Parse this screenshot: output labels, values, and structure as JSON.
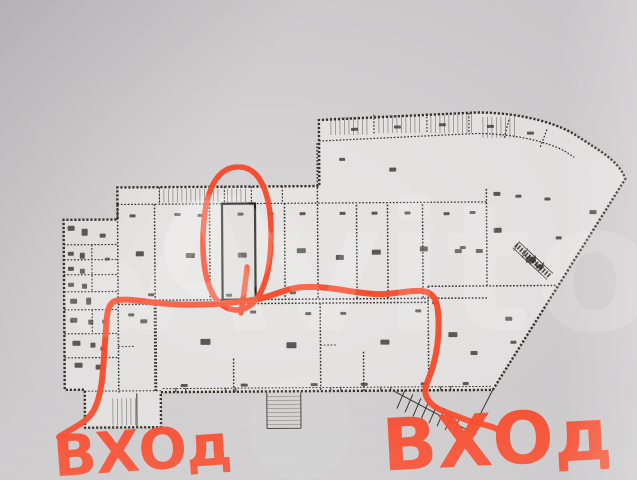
{
  "watermark": {
    "text": "Avito"
  },
  "annotations": {
    "entrance_left_label": "ВХОд",
    "entrance_right_label": "ВХОд",
    "marker_color": "#f8492a"
  },
  "plan": {
    "ink_color": "#35322d"
  }
}
